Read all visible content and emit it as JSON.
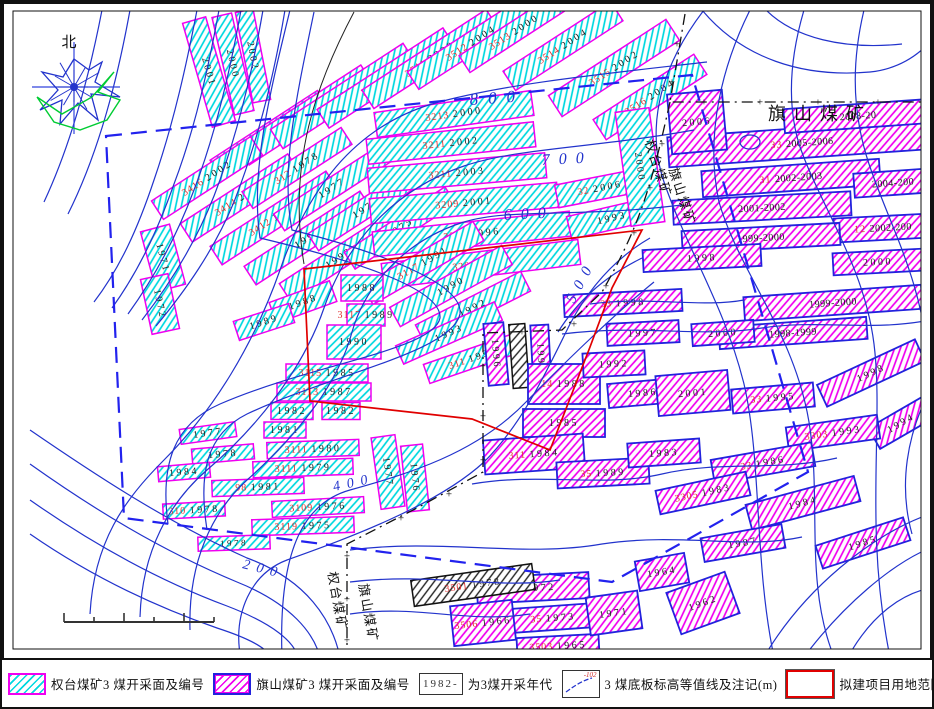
{
  "colors": {
    "cyan_hatch": "#00D8E0",
    "magenta_hatch": "#F000F0",
    "qt_border": "#F000F0",
    "qs_border": "#2222DD",
    "black_hatch": "#222222",
    "contour": "#2233CC",
    "red_boundary": "#E00000",
    "assess_boundary": "#2222EE",
    "mine_boundary": "#111111",
    "face_code": "#E03030",
    "face_year": "#222222"
  },
  "map": {
    "north": {
      "label": "北",
      "cx": 72,
      "cy": 85,
      "blue_poly": "72,57 87,68 100,60 93,80 118,95 89,92 96,118 76,101 58,122 60,98 38,108 56,88 40,70 61,75",
      "green_path": "M35 95 L52 120 L78 128 L105 118 L118 98 L96 90 L112 70 L90 95 L60 112 L35 95",
      "spokes": [
        0,
        30,
        60,
        90,
        120,
        150,
        180,
        210,
        240,
        270,
        300,
        330
      ]
    },
    "mine_labels": [
      {
        "t": "旗山煤矿",
        "x": 818,
        "y": 118,
        "rot": 0,
        "size": 18,
        "ls": 8,
        "color": "#111"
      },
      {
        "t": "权台煤矿",
        "x": 652,
        "y": 168,
        "rot": 72,
        "size": 13,
        "ls": 2,
        "color": "#111"
      },
      {
        "t": "旗山煤矿",
        "x": 676,
        "y": 196,
        "rot": 72,
        "size": 13,
        "ls": 2,
        "color": "#111"
      },
      {
        "t": "权台煤矿",
        "x": 331,
        "y": 600,
        "rot": 80,
        "size": 13,
        "ls": 2,
        "color": "#111"
      },
      {
        "t": "旗山煤矿",
        "x": 362,
        "y": 612,
        "rot": 80,
        "size": 13,
        "ls": 2,
        "color": "#111"
      }
    ],
    "contour_labels": [
      {
        "t": "800",
        "x": 468,
        "y": 103,
        "rot": -4,
        "size": 17,
        "ls": 10
      },
      {
        "t": "700",
        "x": 540,
        "y": 163,
        "rot": -3,
        "size": 16,
        "ls": 9
      },
      {
        "t": "600",
        "x": 502,
        "y": 218,
        "rot": -3,
        "size": 16,
        "ls": 9
      },
      {
        "t": "500",
        "x": 572,
        "y": 302,
        "rot": -62,
        "size": 15,
        "ls": 8
      },
      {
        "t": "400",
        "x": 332,
        "y": 489,
        "rot": -12,
        "size": 14,
        "ls": 7
      },
      {
        "t": "200",
        "x": 240,
        "y": 566,
        "rot": 14,
        "size": 14,
        "ls": 7
      }
    ],
    "contours": [
      "M195 8 C185 60 172 120 152 178 C136 226 118 266 92 300",
      "M217 8 C207 62 194 124 172 182 C155 230 136 270 110 306",
      "M239 8 C229 64 215 128 192 188 C174 236 152 276 126 312",
      "M261 8 C251 66 236 132 212 194 C193 242 168 282 140 318",
      "M283 8 C273 68 257 136 232 200 C212 248 184 288 154 324",
      "M100 8 C88 70 70 140 42 200",
      "M128 8 C116 74 98 148 66 212",
      "M705 60 C600 72 500 82 430 102 C350 126 305 190 278 268 C252 342 212 408 162 458 C122 498 92 540 88 612",
      "M692 128 C592 146 515 146 462 164 C385 190 342 248 322 306 C300 370 252 428 205 468 C168 500 140 548 138 615",
      "M680 203 C575 216 508 206 462 220 C398 240 362 288 350 330 C335 386 290 438 245 478 C210 510 186 560 188 628",
      "M648 236 C610 258 585 290 568 322 C546 366 522 420 482 460 C432 506 335 540 285 558 C248 572 232 612 238 652",
      "M652 280 C615 310 565 358 524 400 C474 452 405 472 348 488 C305 500 276 542 280 655",
      "M640 256 C600 276 575 300 556 330",
      "M288 8 C268 90 248 170 258 236 C350 258 440 286 438 316 C432 348 310 362 218 402 C172 422 158 462 166 522",
      "M312 10 C295 92 278 168 290 228 C370 248 462 280 458 312 C450 350 330 372 245 412 C205 432 196 470 205 528",
      "M28 428 C95 474 165 520 245 556 C305 578 330 618 338 655",
      "M28 462 C90 506 158 548 235 580 C290 602 312 632 318 655",
      "M28 498 C85 538 150 576 225 604 C272 622 292 640 296 655",
      "M28 532 C80 568 140 600 215 626 C252 638 266 648 268 655",
      "M348 548 C440 536 520 556 600 542 C680 530 740 548 800 535",
      "M348 580 C430 570 495 588 558 578",
      "M348 612 C415 602 465 622 528 612",
      "M470 482 C540 470 600 486 660 472 C720 458 775 470 835 456",
      "M560 332 C640 322 700 336 760 326 C818 317 868 330 928 318",
      "M588 302 C648 294 700 306 742 298",
      "M702 8 C662 60 642 120 662 180 C686 250 722 302 742 382 C760 460 752 560 772 655",
      "M748 8 C722 60 702 130 717 200 C737 270 792 330 807 420 C820 500 802 580 832 655",
      "M802 8 C792 42 782 92 797 142 C817 202 862 262 872 342 C882 422 862 522 887 650",
      "M862 8 C852 50 847 102 867 162 C887 222 922 282 926 362",
      "M926 392 C906 432 896 482 910 532",
      "M700 8 C740 56 800 76 868 70 C896 67 915 54 928 40",
      "M764 8 C792 36 842 48 900 42",
      "M846 655 C870 612 900 592 928 586",
      "M802 655 C842 602 890 562 928 546",
      "M762 655 C802 587 870 532 928 512",
      "M738 140 a10 7 0 1 0 20 0 a10 7 0 1 0 -20 0"
    ],
    "extra_lines": [
      {
        "d": "M352 10 C315 80 285 160 302 262",
        "color": "#222",
        "w": 1
      }
    ],
    "red_area": "M302 267 L640 228 L610 286 L588 345 L548 448 L470 417 L308 399 Z",
    "assess_area": "M104 134 L690 73 L806 470 L610 580 L122 516 Z",
    "mine_boundary": [
      "M683 12 L668 100 L928 100",
      "M668 100 C650 180 640 220 600 290 L560 328 L481 331 L481 470 L415 506 L345 542 L345 655"
    ],
    "plus_marks": [
      [
        675,
        42
      ],
      [
        670,
        80
      ],
      [
        702,
        100
      ],
      [
        758,
        100
      ],
      [
        816,
        100
      ],
      [
        876,
        100
      ],
      [
        660,
        142
      ],
      [
        648,
        186
      ],
      [
        632,
        231
      ],
      [
        604,
        284
      ],
      [
        572,
        322
      ],
      [
        520,
        330
      ],
      [
        481,
        364
      ],
      [
        481,
        414
      ],
      [
        481,
        458
      ],
      [
        447,
        492
      ],
      [
        399,
        516
      ],
      [
        345,
        554
      ],
      [
        345,
        597
      ],
      [
        345,
        638
      ]
    ],
    "scale_bar": {
      "x": 62,
      "y": 620,
      "len": 150,
      "segs": 5
    },
    "faces": [
      [
        207,
        70,
        24,
        108,
        -16,
        0,
        "2001",
        ""
      ],
      [
        231,
        62,
        20,
        100,
        -13,
        0,
        "2000",
        ""
      ],
      [
        251,
        54,
        18,
        92,
        -11,
        0,
        "2002",
        ""
      ],
      [
        268,
        133,
        128,
        23,
        -33,
        0,
        "2004",
        "3410"
      ],
      [
        303,
        113,
        148,
        23,
        -33,
        0,
        "2000",
        "3412"
      ],
      [
        341,
        94,
        158,
        23,
        -33,
        0,
        "2000",
        "3414"
      ],
      [
        384,
        76,
        150,
        22,
        -33,
        0,
        "1999",
        "3411"
      ],
      [
        428,
        57,
        148,
        22,
        -33,
        0,
        "2000",
        "3511"
      ],
      [
        469,
        41,
        138,
        21,
        -33,
        0,
        "2004",
        "3512"
      ],
      [
        512,
        30,
        118,
        20,
        -33,
        0,
        "2000",
        "3513"
      ],
      [
        561,
        44,
        128,
        23,
        -33,
        0,
        "2004",
        "3514"
      ],
      [
        612,
        66,
        140,
        25,
        -33,
        0,
        "2002",
        "3515"
      ],
      [
        648,
        95,
        120,
        24,
        -33,
        0,
        "2004",
        "3516"
      ],
      [
        205,
        176,
        118,
        22,
        -33,
        0,
        "2002",
        "3416"
      ],
      [
        238,
        196,
        128,
        22,
        -33,
        0,
        "2002",
        "3414"
      ],
      [
        272,
        216,
        138,
        22,
        -33,
        0,
        "1994",
        "3412"
      ],
      [
        306,
        236,
        138,
        22,
        -33,
        0,
        "1993",
        ""
      ],
      [
        337,
        256,
        128,
        22,
        -33,
        0,
        "1992",
        ""
      ],
      [
        295,
        166,
        118,
        20,
        -33,
        0,
        "1978",
        "312"
      ],
      [
        330,
        186,
        126,
        20,
        -33,
        0,
        "1977",
        ""
      ],
      [
        364,
        206,
        126,
        20,
        -33,
        0,
        "1976",
        ""
      ],
      [
        398,
        226,
        120,
        20,
        -33,
        0,
        "1975",
        ""
      ],
      [
        452,
        112,
        158,
        25,
        -8,
        0,
        "2000",
        "3213"
      ],
      [
        449,
        141,
        168,
        25,
        -6,
        0,
        "2002",
        "3211"
      ],
      [
        455,
        171,
        178,
        25,
        -5,
        0,
        "2003",
        "3211"
      ],
      [
        462,
        201,
        188,
        25,
        -5,
        0,
        "2001",
        "3209"
      ],
      [
        470,
        232,
        198,
        25,
        -6,
        0,
        "1996",
        "3207"
      ],
      [
        479,
        262,
        198,
        25,
        -7,
        0,
        "1994",
        "3205"
      ],
      [
        598,
        186,
        88,
        23,
        -11,
        0,
        "2006",
        "32"
      ],
      [
        610,
        216,
        88,
        23,
        -13,
        0,
        "1993",
        ""
      ],
      [
        638,
        165,
        34,
        115,
        -8,
        0,
        "2000",
        ""
      ],
      [
        421,
        261,
        128,
        22,
        -30,
        0,
        "1991",
        "3117"
      ],
      [
        449,
        284,
        128,
        22,
        -29,
        0,
        "1990",
        ""
      ],
      [
        471,
        306,
        118,
        22,
        -27,
        0,
        "1992",
        ""
      ],
      [
        447,
        331,
        108,
        20,
        -24,
        0,
        "1993",
        ""
      ],
      [
        471,
        356,
        98,
        20,
        -19,
        0,
        "1994",
        "311"
      ],
      [
        360,
        286,
        42,
        26,
        0,
        0,
        "1988",
        ""
      ],
      [
        364,
        313,
        38,
        22,
        0,
        0,
        "1989",
        "3117"
      ],
      [
        352,
        340,
        54,
        34,
        0,
        0,
        "1990",
        ""
      ],
      [
        325,
        371,
        82,
        18,
        0,
        0,
        "1985",
        "3115"
      ],
      [
        322,
        390,
        94,
        18,
        0,
        0,
        "1987",
        "3113"
      ],
      [
        290,
        409,
        42,
        17,
        0,
        0,
        "1982",
        ""
      ],
      [
        339,
        409,
        38,
        17,
        0,
        0,
        "1982",
        ""
      ],
      [
        283,
        428,
        42,
        16,
        0,
        0,
        "1981",
        ""
      ],
      [
        301,
        300,
        64,
        22,
        -20,
        0,
        "1988",
        ""
      ],
      [
        262,
        320,
        58,
        20,
        -18,
        0,
        "1989",
        ""
      ],
      [
        161,
        256,
        30,
        62,
        -15,
        0,
        "1971",
        ""
      ],
      [
        158,
        302,
        28,
        56,
        -12,
        0,
        "1972",
        ""
      ],
      [
        311,
        447,
        92,
        16,
        -2,
        0,
        "1980",
        "3111"
      ],
      [
        301,
        466,
        100,
        16,
        -2,
        0,
        "1979",
        "3111"
      ],
      [
        256,
        485,
        92,
        16,
        -2,
        0,
        "1981",
        "98"
      ],
      [
        316,
        505,
        92,
        16,
        -3,
        0,
        "1976",
        "3109"
      ],
      [
        301,
        524,
        102,
        16,
        -2,
        0,
        "1975",
        "3119"
      ],
      [
        221,
        452,
        62,
        15,
        -5,
        0,
        "1978",
        ""
      ],
      [
        206,
        431,
        56,
        15,
        -8,
        0,
        "1977",
        ""
      ],
      [
        182,
        470,
        52,
        15,
        -5,
        0,
        "1984",
        ""
      ],
      [
        192,
        508,
        62,
        15,
        -3,
        0,
        "1978",
        "310"
      ],
      [
        232,
        541,
        72,
        14,
        -2,
        0,
        "1978",
        ""
      ],
      [
        386,
        470,
        24,
        72,
        -8,
        0,
        "1977",
        ""
      ],
      [
        413,
        476,
        22,
        66,
        -6,
        0,
        "1976",
        ""
      ],
      [
        494,
        352,
        20,
        62,
        -5,
        1,
        "1996",
        ""
      ],
      [
        517,
        354,
        16,
        64,
        -4,
        2,
        "",
        ""
      ],
      [
        539,
        356,
        18,
        66,
        -3,
        1,
        "1992",
        ""
      ],
      [
        562,
        382,
        72,
        40,
        0,
        1,
        "1988",
        "14"
      ],
      [
        562,
        421,
        82,
        28,
        0,
        1,
        "1985",
        ""
      ],
      [
        532,
        452,
        100,
        34,
        -4,
        1,
        "1984",
        "311"
      ],
      [
        612,
        362,
        62,
        24,
        -3,
        1,
        "1992",
        ""
      ],
      [
        641,
        391,
        70,
        24,
        -5,
        1,
        "1986",
        ""
      ],
      [
        601,
        471,
        92,
        26,
        -3,
        1,
        "1989",
        "35"
      ],
      [
        662,
        451,
        72,
        24,
        -4,
        1,
        "1983",
        ""
      ],
      [
        531,
        586,
        112,
        26,
        -3,
        1,
        "1972",
        "35"
      ],
      [
        551,
        616,
        92,
        24,
        -4,
        1,
        "1973",
        "35"
      ],
      [
        481,
        621,
        62,
        40,
        -6,
        1,
        "1966",
        "3506"
      ],
      [
        556,
        644,
        82,
        20,
        -3,
        1,
        "1965",
        "3503"
      ],
      [
        612,
        611,
        52,
        38,
        -8,
        1,
        "1971",
        ""
      ],
      [
        471,
        583,
        122,
        26,
        -8,
        2,
        "1978",
        "3501"
      ],
      [
        701,
        601,
        62,
        44,
        -20,
        1,
        "1962",
        ""
      ],
      [
        660,
        570,
        50,
        30,
        -10,
        1,
        "1964",
        ""
      ],
      [
        800,
        141,
        268,
        30,
        -4,
        1,
        "2005-2006",
        "33"
      ],
      [
        856,
        114,
        148,
        24,
        -4,
        1,
        "2008-20",
        ""
      ],
      [
        789,
        176,
        178,
        26,
        -4,
        1,
        "2002-2003",
        "31"
      ],
      [
        891,
        181,
        78,
        24,
        -4,
        1,
        "2004-200",
        ""
      ],
      [
        760,
        206,
        178,
        24,
        -3,
        1,
        "2001-2002",
        ""
      ],
      [
        881,
        226,
        98,
        24,
        -3,
        1,
        "2002-200",
        "12"
      ],
      [
        759,
        236,
        158,
        22,
        -3,
        1,
        "1999-2000",
        ""
      ],
      [
        700,
        256,
        118,
        22,
        -3,
        1,
        "1998",
        ""
      ],
      [
        695,
        120,
        55,
        60,
        -5,
        1,
        "2006",
        ""
      ],
      [
        621,
        301,
        118,
        22,
        -3,
        1,
        "1998",
        "33"
      ],
      [
        831,
        301,
        178,
        24,
        -4,
        1,
        "1999-2000",
        ""
      ],
      [
        791,
        331,
        148,
        22,
        -4,
        1,
        "1998-1999",
        ""
      ],
      [
        721,
        331,
        62,
        22,
        -4,
        1,
        "2000",
        ""
      ],
      [
        641,
        331,
        72,
        22,
        -3,
        1,
        "1997",
        ""
      ],
      [
        869,
        371,
        108,
        24,
        -25,
        1,
        "1998",
        ""
      ],
      [
        899,
        421,
        62,
        24,
        -30,
        1,
        "1994",
        ""
      ],
      [
        771,
        396,
        82,
        24,
        -5,
        1,
        "1995",
        "33"
      ],
      [
        831,
        431,
        92,
        24,
        -8,
        1,
        "1993",
        "3303"
      ],
      [
        761,
        461,
        102,
        24,
        -10,
        1,
        "1986",
        "33"
      ],
      [
        701,
        491,
        92,
        24,
        -12,
        1,
        "1983",
        "3305"
      ],
      [
        801,
        501,
        112,
        26,
        -15,
        1,
        "1984",
        ""
      ],
      [
        861,
        541,
        92,
        24,
        -18,
        1,
        "1985",
        ""
      ],
      [
        741,
        541,
        82,
        24,
        -10,
        1,
        "1987",
        ""
      ],
      [
        691,
        391,
        72,
        40,
        -5,
        1,
        "2001",
        ""
      ],
      [
        876,
        260,
        90,
        22,
        -3,
        1,
        "2000",
        ""
      ]
    ]
  },
  "legend": {
    "items": [
      {
        "type": "swatch-qt",
        "label": "权台煤矿3 煤开采面及编号"
      },
      {
        "type": "swatch-qs",
        "label": "旗山煤矿3 煤开采面及编号"
      },
      {
        "type": "year-box",
        "box_text": "1982-",
        "label": "为3煤开采年代"
      },
      {
        "type": "contour-box",
        "anno": "-102",
        "label": "3 煤底板标高等值线及注记(m)"
      },
      {
        "type": "red-box",
        "label": "拟建项目用地范围"
      },
      {
        "type": "dash-box",
        "label": "评估区范围"
      },
      {
        "type": "boundary-box",
        "box_text": "—+—",
        "label": "权台、旗山煤矿矿区范围界线"
      }
    ]
  }
}
